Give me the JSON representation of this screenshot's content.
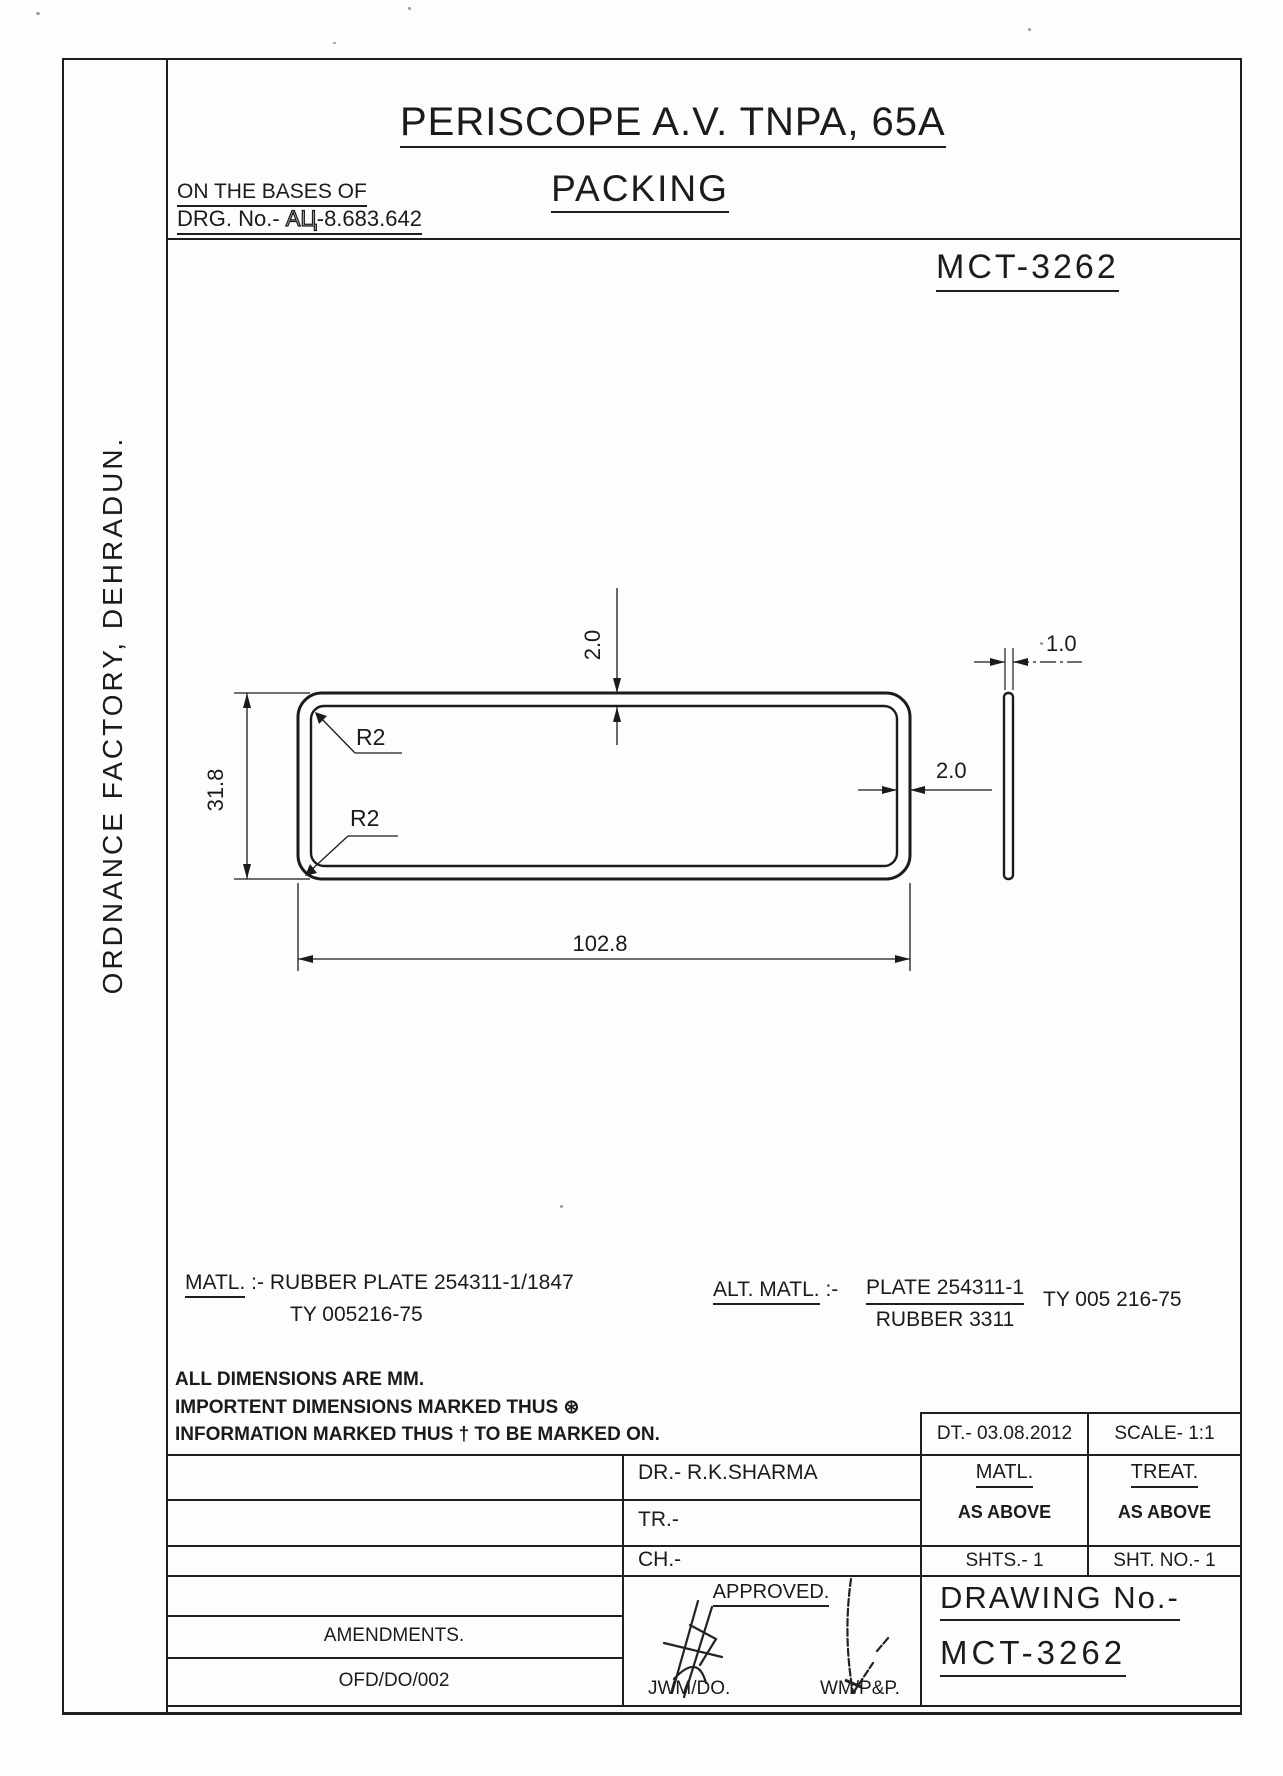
{
  "header": {
    "title_line1": "PERISCOPE A.V. TNPA, 65A",
    "title_line2": "PACKING",
    "basis_label": "ON THE BASES OF",
    "drg_prefix": "DRG. No.- ",
    "drg_code_hollow": "АЦ",
    "drg_code_rest": "-8.683.642",
    "doc_number": "MCT-3262"
  },
  "left_margin": {
    "factory": "ORDNANCE FACTORY, DEHRADUN."
  },
  "drawing": {
    "dims": {
      "height": "31.8",
      "width": "102.8",
      "wall_top": "2.0",
      "wall_right": "2.0",
      "thickness": "1.0",
      "radius_top": "R2",
      "radius_bottom": "R2"
    }
  },
  "materials": {
    "matl_label": "MATL.",
    "matl_sep": ":-",
    "matl_value": "RUBBER PLATE 254311-1/1847",
    "matl_spec": "TY 005216-75",
    "alt_label": "ALT. MATL.",
    "alt_sep": ":-",
    "alt_value_top": "PLATE 254311-1",
    "alt_value_bottom": "RUBBER 3311",
    "alt_spec": "TY 005 216-75"
  },
  "notes": [
    "ALL DIMENSIONS ARE MM.",
    "IMPORTENT DIMENSIONS MARKED THUS ⊛",
    "INFORMATION MARKED THUS † TO BE MARKED ON."
  ],
  "title_block": {
    "dt": "DT.- 03.08.2012",
    "scale": "SCALE-  1:1",
    "matl_header": "MATL.",
    "matl_value": "AS ABOVE",
    "treat_header": "TREAT.",
    "treat_value": "AS ABOVE",
    "shts": "SHTS.-  1",
    "sht_no": "SHT. NO.-  1",
    "dr": "DR.-  R.K.SHARMA",
    "tr": "TR.-",
    "ch": "CH.-",
    "approved": "APPROVED.",
    "sig1": "JWM/DO.",
    "sig2": "WM/P&P.",
    "amendments": "AMENDMENTS.",
    "amendment_no": "OFD/DO/002",
    "drawing_no_label": "DRAWING No.-",
    "drawing_no": "MCT-3262"
  }
}
